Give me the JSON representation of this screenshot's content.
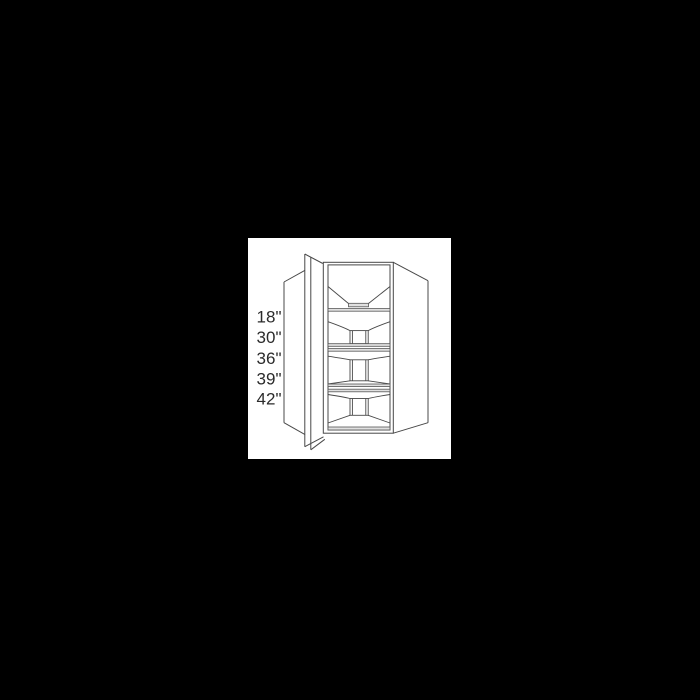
{
  "lightbox": {
    "background_color": "#000000"
  },
  "product_image": {
    "diagram_name": "diagonal-corner-wall-cabinet-line-drawing",
    "background_color": "#ffffff",
    "line_color": "#484848",
    "shelf_fill_color": "#e0e0e0",
    "label_color": "#2b2b2b",
    "size_labels": [
      "18\"",
      "30\"",
      "36\"",
      "39\"",
      "42\""
    ]
  }
}
